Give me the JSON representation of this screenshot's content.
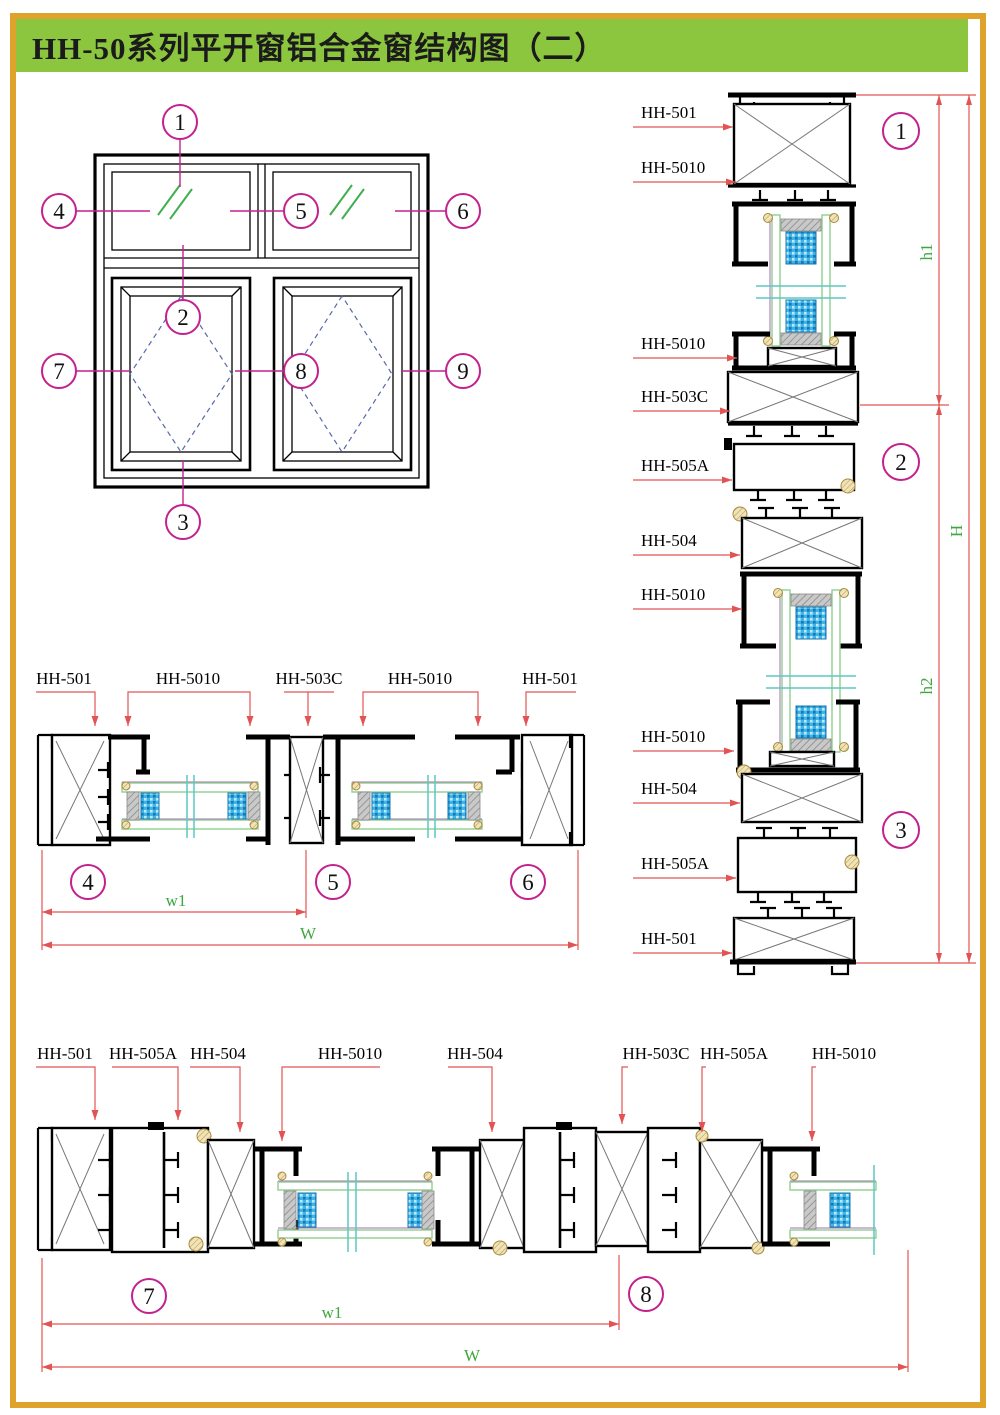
{
  "title": "HH-50系列平开窗铝合金窗结构图（二）",
  "colors": {
    "page_border": "#DFA32B",
    "title_background": "#8CC63F",
    "title_text": "#1B1B1B",
    "profile_line": "#000000",
    "leader_red": "#E25353",
    "marker_magenta": "#C2218E",
    "dimension_text_green": "#3FA73F",
    "glass_edge_green": "#8FCF8F",
    "glass_symbol_green": "#3FAF4F",
    "break_line_cyan": "#5BC8C4",
    "open_direction_dashed_blue": "#5868A8",
    "spacer_gray": "#A9A9A9",
    "desiccant_blue": "#3FB4E8",
    "gasket_tan": "#E3D49F",
    "pane_edge_purple": "#A86AB8"
  },
  "elevation": {
    "markers": [
      "1",
      "2",
      "3",
      "4",
      "5",
      "6",
      "7",
      "8",
      "9"
    ]
  },
  "vertical_section": {
    "labels": [
      "HH-501",
      "HH-5010",
      "HH-5010",
      "HH-503C",
      "HH-505A",
      "HH-504",
      "HH-5010",
      "HH-5010",
      "HH-504",
      "HH-505A",
      "HH-501"
    ],
    "markers": [
      "1",
      "2",
      "3"
    ],
    "dims": [
      "h1",
      "H",
      "h2"
    ]
  },
  "middle_section": {
    "labels": [
      "HH-501",
      "HH-5010",
      "HH-503C",
      "HH-5010",
      "HH-501"
    ],
    "markers": [
      "4",
      "5",
      "6"
    ],
    "dims": [
      "w1",
      "W"
    ]
  },
  "bottom_section": {
    "labels": [
      "HH-501",
      "HH-505A",
      "HH-504",
      "HH-5010",
      "HH-504",
      "HH-503C",
      "HH-505A",
      "HH-5010"
    ],
    "markers": [
      "7",
      "8"
    ],
    "dims": [
      "w1",
      "W"
    ]
  }
}
